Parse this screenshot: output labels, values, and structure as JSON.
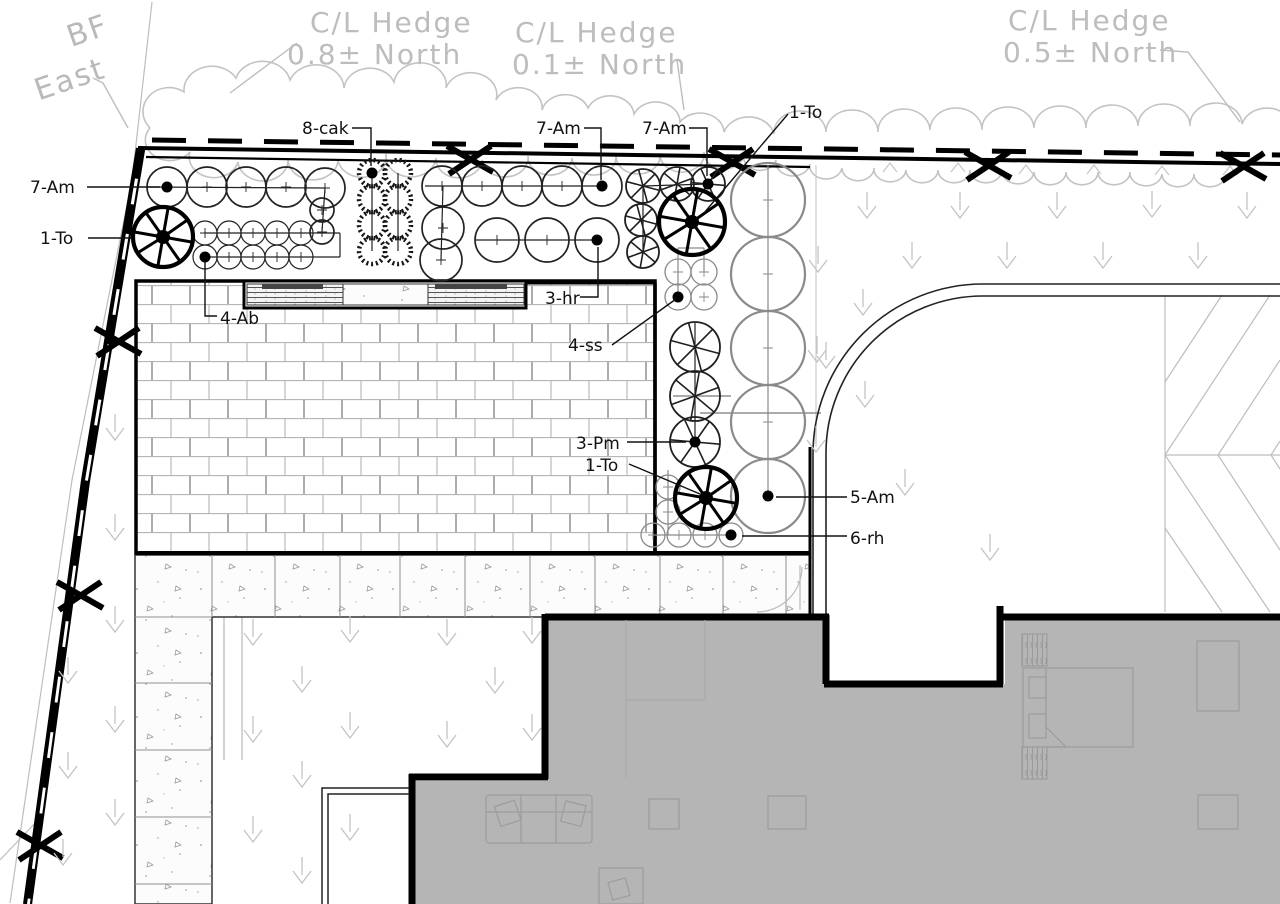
{
  "title": "Landscape planting plan",
  "colors": {
    "linework": "#111111",
    "heavy": "#000000",
    "reference_gray": "#bdbdbd",
    "arrow_gray": "#c4c4c4",
    "building_fill": "#b5b5b5",
    "furniture_gray": "#9c9c9c",
    "brick_joint": "#adadad"
  },
  "bf_label": {
    "line1": "BF",
    "line2": "East"
  },
  "hedge_labels": {
    "h1": {
      "line1": "C/L Hedge",
      "line2": "0.8± North"
    },
    "h2": {
      "line1": "C/L Hedge",
      "line2": "0.1± North"
    },
    "h3": {
      "line1": "C/L Hedge",
      "line2": "0.5± North"
    }
  },
  "plant_labels": [
    {
      "text": "7-Am"
    },
    {
      "text": "1-To"
    },
    {
      "text": "8-cak"
    },
    {
      "text": "7-Am"
    },
    {
      "text": "7-Am"
    },
    {
      "text": "1-To"
    },
    {
      "text": "4-Ab"
    },
    {
      "text": "3-hr"
    },
    {
      "text": "4-ss"
    },
    {
      "text": "3-Pm"
    },
    {
      "text": "1-To"
    },
    {
      "text": "5-Am"
    },
    {
      "text": "6-rh"
    }
  ],
  "plan": {
    "groups": [
      {
        "name": "7-Am-row-west",
        "sym": "shrub",
        "r": 20,
        "pts": [
          [
            167,
            187
          ],
          [
            207,
            187
          ],
          [
            246,
            187
          ],
          [
            286,
            187
          ],
          [
            325,
            188
          ]
        ],
        "conn": [
          [
            148,
            187,
            325,
            188
          ],
          [
            325,
            188,
            322,
            232
          ]
        ],
        "dot": [
          167,
          187
        ]
      },
      {
        "name": "7-Am-west-col",
        "sym": "shrub",
        "r": 12,
        "pts": [
          [
            322,
            210
          ],
          [
            322,
            232
          ]
        ]
      },
      {
        "name": "4-Ab",
        "sym": "shrub",
        "r": 12,
        "sw": 1.2,
        "pts": [
          [
            205,
            233
          ],
          [
            229,
            233
          ],
          [
            253,
            233
          ],
          [
            277,
            233
          ],
          [
            301,
            233
          ],
          [
            205,
            257
          ],
          [
            229,
            257
          ],
          [
            253,
            257
          ],
          [
            277,
            257
          ],
          [
            301,
            257
          ]
        ],
        "conn": [
          [
            205,
            233,
            340,
            233
          ],
          [
            340,
            233,
            340,
            257
          ],
          [
            340,
            257,
            205,
            257
          ]
        ],
        "dot": [
          205,
          257
        ]
      },
      {
        "name": "8-cak",
        "sym": "grass",
        "r": 13,
        "pts": [
          [
            372,
            173
          ],
          [
            398,
            173
          ],
          [
            372,
            199
          ],
          [
            398,
            199
          ],
          [
            372,
            225
          ],
          [
            398,
            225
          ],
          [
            372,
            251
          ],
          [
            398,
            251
          ]
        ],
        "conn": [
          [
            372,
            173,
            372,
            251
          ],
          [
            398,
            173,
            398,
            251
          ]
        ],
        "dot": [
          372,
          173
        ]
      },
      {
        "name": "7-Am-row-mid",
        "sym": "shrub",
        "r": 20,
        "pts": [
          [
            442,
            186
          ],
          [
            482,
            186
          ],
          [
            522,
            186
          ],
          [
            562,
            186
          ],
          [
            602,
            186
          ]
        ],
        "conn": [
          [
            425,
            186,
            602,
            186
          ],
          [
            443,
            186,
            441,
            260
          ]
        ],
        "dot": [
          602,
          186
        ]
      },
      {
        "name": "7-Am-mid-col",
        "sym": "shrub",
        "r": 21,
        "pts": [
          [
            443,
            228
          ],
          [
            441,
            260
          ]
        ]
      },
      {
        "name": "3-hr",
        "sym": "shrub",
        "r": 22,
        "pts": [
          [
            497,
            240
          ],
          [
            547,
            240
          ],
          [
            597,
            240
          ]
        ],
        "conn": [
          [
            475,
            240,
            597,
            240
          ]
        ],
        "dot": [
          597,
          240
        ]
      },
      {
        "name": "7-Am-row-east",
        "sym": "pine",
        "r": 17,
        "pts": [
          [
            643,
            186
          ],
          [
            677,
            184
          ],
          [
            708,
            184
          ]
        ],
        "conn": [
          [
            643,
            186,
            708,
            184
          ],
          [
            643,
            186,
            643,
            252
          ]
        ],
        "dot": [
          708,
          184
        ]
      },
      {
        "name": "7-Am-east-col",
        "sym": "pine",
        "r": 16,
        "pts": [
          [
            641,
            220
          ],
          [
            643,
            252
          ]
        ]
      },
      {
        "name": "4-ss",
        "sym": "shrubg",
        "r": 13,
        "sw": 1.3,
        "pts": [
          [
            678,
            272
          ],
          [
            704,
            272
          ],
          [
            678,
            297
          ],
          [
            704,
            297
          ]
        ],
        "conn": [
          [
            678,
            248,
            704,
            248
          ],
          [
            678,
            248,
            678,
            297
          ],
          [
            704,
            248,
            704,
            272
          ]
        ],
        "dot": [
          678,
          297
        ]
      },
      {
        "name": "5-Am",
        "sym": "shrubg",
        "r": 37,
        "sw": 2.2,
        "pts": [
          [
            768,
            200
          ],
          [
            768,
            274
          ],
          [
            768,
            348
          ],
          [
            768,
            422
          ],
          [
            768,
            496
          ]
        ],
        "conn": [
          [
            768,
            165,
            768,
            496
          ]
        ],
        "dot": [
          768,
          496
        ]
      },
      {
        "name": "3-Pm",
        "sym": "pine",
        "r": 25,
        "pts": [
          [
            695,
            347
          ],
          [
            695,
            396
          ],
          [
            695,
            442
          ]
        ],
        "conn": [
          [
            695,
            323,
            695,
            442
          ]
        ],
        "dot": [
          695,
          442
        ]
      },
      {
        "name": "6-rh",
        "sym": "shrubg",
        "r": 12,
        "sw": 1.3,
        "pts": [
          [
            668,
            487
          ],
          [
            668,
            512
          ],
          [
            653,
            535
          ],
          [
            679,
            535
          ],
          [
            705,
            535
          ],
          [
            731,
            535
          ]
        ],
        "conn": [
          [
            668,
            470,
            668,
            535
          ],
          [
            653,
            535,
            731,
            535
          ]
        ],
        "dot": [
          731,
          535
        ]
      }
    ],
    "trees": [
      [
        163,
        237,
        30
      ],
      [
        692,
        222,
        33
      ],
      [
        706,
        498,
        31
      ]
    ],
    "arrows": [
      [
        867,
        218
      ],
      [
        960,
        218
      ],
      [
        1057,
        218
      ],
      [
        1152,
        217
      ],
      [
        1247,
        218
      ],
      [
        912,
        268
      ],
      [
        1007,
        268
      ],
      [
        1103,
        268
      ],
      [
        1198,
        268
      ],
      [
        863,
        315
      ],
      [
        826,
        368
      ],
      [
        818,
        272
      ],
      [
        817,
        362
      ],
      [
        816,
        452
      ],
      [
        865,
        407
      ],
      [
        905,
        495
      ],
      [
        990,
        560
      ],
      [
        115,
        440
      ],
      [
        115,
        540
      ],
      [
        115,
        632
      ],
      [
        115,
        732
      ],
      [
        115,
        825
      ],
      [
        68,
        683
      ],
      [
        68,
        778
      ],
      [
        63,
        865
      ],
      [
        253,
        645
      ],
      [
        350,
        642
      ],
      [
        302,
        692
      ],
      [
        253,
        742
      ],
      [
        350,
        738
      ],
      [
        302,
        787
      ],
      [
        253,
        842
      ],
      [
        350,
        840
      ],
      [
        302,
        883
      ],
      [
        447,
        645
      ],
      [
        532,
        643
      ],
      [
        495,
        693
      ],
      [
        447,
        747
      ],
      [
        532,
        740
      ]
    ],
    "x_marks": [
      [
        470,
        159
      ],
      [
        732,
        162
      ],
      [
        988,
        165
      ],
      [
        1243,
        166
      ],
      [
        118,
        341
      ],
      [
        80,
        595
      ],
      [
        40,
        845
      ]
    ]
  }
}
